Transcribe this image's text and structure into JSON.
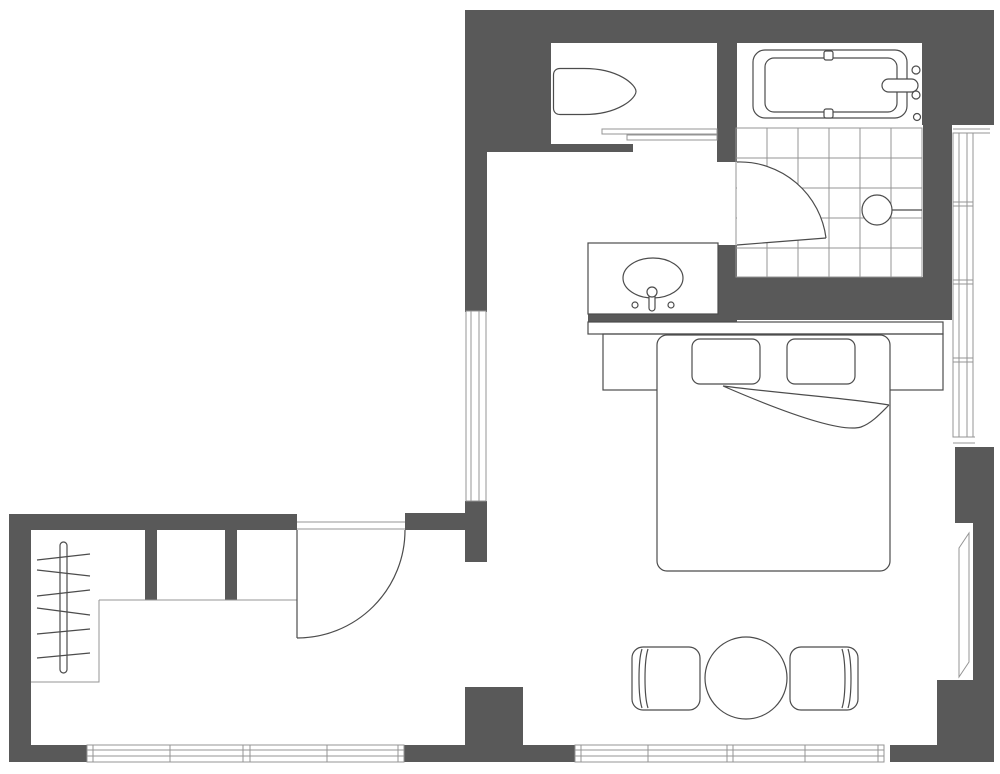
{
  "colors": {
    "wall": "#595959",
    "line": "#4c4c4c",
    "thin": "#949494",
    "background": "#ffffff"
  },
  "plan": {
    "type": "apartment-floor-plan",
    "fixtures": [
      "toilet",
      "bathtub",
      "shower-floor-tiles",
      "floor-drain",
      "vanity-sink",
      "wardrobe-rail",
      "wardrobe-hangers",
      "bed-platform",
      "mattress",
      "pillow-left",
      "pillow-right",
      "blanket-fold",
      "dining-table",
      "dining-chair-left",
      "dining-chair-right"
    ],
    "openings": [
      "entry-door-swing",
      "bathroom-door-swing",
      "wc-sliding-door"
    ],
    "windows": [
      "left-wall-window",
      "right-wall-window",
      "angled-side-window",
      "bottom-left-window",
      "bottom-right-window"
    ]
  }
}
